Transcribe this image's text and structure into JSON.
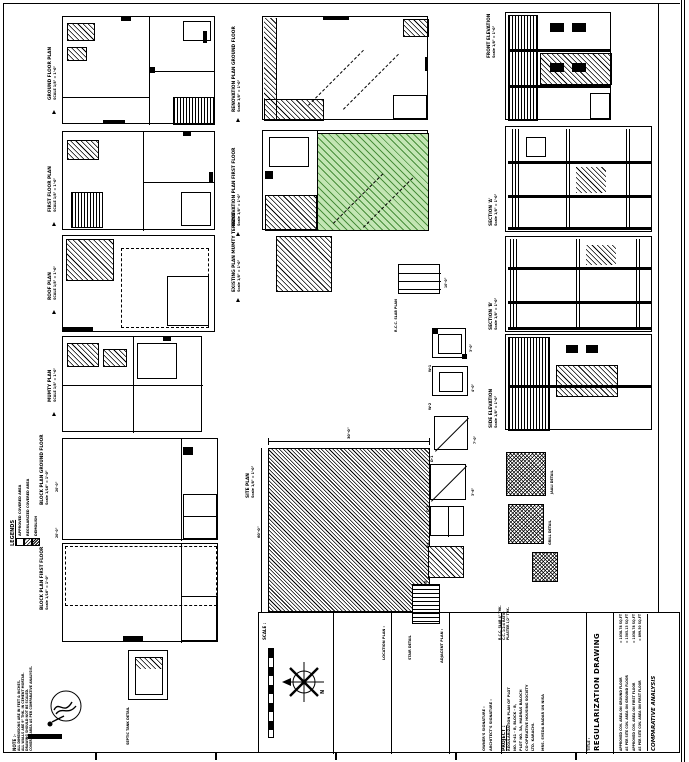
{
  "colors": {
    "paper": "#ffffff",
    "line": "#000000",
    "green_fill": "#c3e6b4",
    "green_hatch": "#4a8f3c"
  },
  "drawings": {
    "left_column": [
      {
        "title": "GROUND FLOOR PLAN",
        "scale": "SCALE 1/8\" = 1'-0\""
      },
      {
        "title": "FIRST FLOOR PLAN",
        "scale": "SCALE 1/8\" = 1'-0\""
      },
      {
        "title": "ROOF PLAN",
        "scale": "SCALE 1/8\" = 1'-0\""
      },
      {
        "title": "MUMTY PLAN",
        "scale": "SCALE 1/8\" = 1'-0\""
      },
      {
        "title": "BLOCK PLAN GROUND FLOOR",
        "scale": "Scale 1/16\" = 1'-0\""
      },
      {
        "title": "BLOCK PLAN FIRST FLOOR",
        "scale": "Scale 1/16\" = 1'-0\""
      }
    ],
    "center_column": [
      {
        "title": "RENOVATION PLAN GROUND FLOOR",
        "scale": "Scale 1/8\" = 1'-0\""
      },
      {
        "title": "RENOVATION PLAN FIRST FLOOR",
        "scale": "Scale 1/8\" = 1'-0\""
      },
      {
        "title": "EXISTING PLAN MUMTY TERRACE",
        "scale": "Scale 1/8\" = 1'-0\""
      },
      {
        "title": "SITE PLAN",
        "scale": "Scale 1/8\" = 1'-0\""
      }
    ],
    "right_column": [
      {
        "title": "FRONT ELEVATION",
        "scale": "Scale 1/8\" = 1'-0\""
      },
      {
        "title": "SECTION 'A'",
        "scale": "Scale 1/8\" = 1'-0\""
      },
      {
        "title": "SECTION 'B'",
        "scale": "Scale 1/8\" = 1'-0\""
      },
      {
        "title": "SIDE ELEVATION",
        "scale": "Scale 1/8\" = 1'-0\""
      }
    ],
    "details": {
      "rcc_slab": "R.C.C. SLAB PLAN",
      "w1": "W-1",
      "w2": "W-2",
      "d1": "D-1",
      "d2": "D-2",
      "v1": "V-1",
      "gate": "GATE",
      "stair": "STAIR DETAIL",
      "jaali": "JAALI DETAIL",
      "grill": "GRILL DETAIL",
      "septic": "SEPTIC TANK DETAIL"
    }
  },
  "dimensions": {
    "d20a": "20'-0\"",
    "d20b": "20'-0\"",
    "d30": "30'-0\"",
    "d60": "60'-0\"",
    "d10": "10'-0\"",
    "d3": "3'-0\"",
    "d4": "4'-0\"",
    "d7": "7'-0\"",
    "d36": "3'-6\""
  },
  "legends": {
    "title": "LEGENDS",
    "items": [
      {
        "label": "APPROVED COVERED AREA"
      },
      {
        "label": "REGULARIZED COVERED AREA"
      },
      {
        "label": "DEMOLISH"
      }
    ]
  },
  "notes": {
    "title": "NOTE :-",
    "lines": [
      "ALL DIMENSIONS ARE IN FEET & INCHES.",
      "ALL WALLS ARE 9\" THK. IN CEMENT MORTAR.",
      "DRAWING SHOULD NOT BE SCALED.",
      "COVERED AREA AS PER COMPARATIVE ANALYSIS."
    ]
  },
  "spec_notes": {
    "lines": [
      "R.C.C. SLAB 4\" THK.",
      "C.C. 1:2:4 RATIO",
      "PLASTER 1/2\" THK."
    ]
  },
  "title_block": {
    "scale_cell": {
      "header": "SCALE :"
    },
    "north_label": "N",
    "location_cell": {
      "header": "LOCATION PLAN :"
    },
    "adjacent_cell": {
      "header": "ADJACENT PLAN :"
    },
    "signature_cell": {
      "line1": "OWNER'S SIGNATURE :",
      "line2": "ARCHITECT'S SIGNATURE :"
    },
    "project_cell": {
      "header": "PROJECT :",
      "lines": [
        "REGULARIZATION PLAN OF PLOT",
        "NO. E-41 - B, BLOCK - B,",
        "PLOT NO. 3A, MADRAS BALOCH",
        "CO-OPERATIVE HOUSING SOCIETY",
        "LTD. KARACHI.",
        "MRS. SYEDA BADAR UN NISA"
      ]
    },
    "title_cell": {
      "header": "TITLE :",
      "value": "REGULARIZATION DRAWING"
    },
    "comparative": {
      "title": "COMPARATIVE ANALYSIS",
      "rows": [
        {
          "label": "APPROVED COV. AREA ON GROUND FLOOR",
          "value": "= 1038.78 SQ.FT"
        },
        {
          "label": "AS PER SITE COV. AREA ON GROUND FLOOR",
          "value": "= 1505.13 SQ.FT"
        },
        {
          "label": "APPROVED COV. AREA ON FIRST FLOOR",
          "value": "= 1038.78 SQ.FT"
        },
        {
          "label": "AS PER SITE COV. AREA ON FIRST FLOOR",
          "value": "= 899.50 SQ.FT"
        }
      ]
    }
  }
}
